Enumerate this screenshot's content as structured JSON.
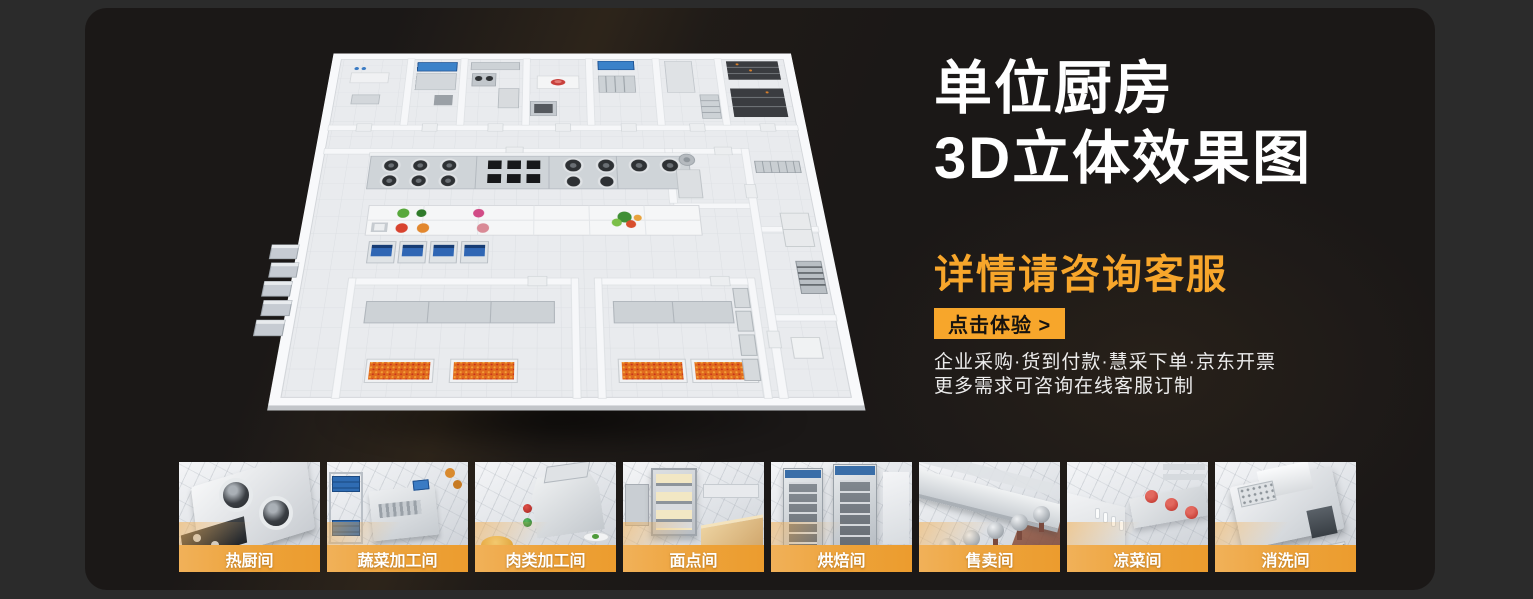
{
  "colors": {
    "page_background": "#2B2B2B",
    "card_background": "#1B1817",
    "accent_orange": "#F7A62B"
  },
  "hero": {
    "title_line1": "单位厨房",
    "title_line2": "3D立体效果图",
    "subtitle": "详情请咨询客服",
    "cta_label": "点击体验 >",
    "note_line1": "企业采购·货到付款·慧采下单·京东开票",
    "note_line2": "更多需求可咨询在线客服订制"
  },
  "gallery": {
    "items": [
      {
        "label": "热厨间"
      },
      {
        "label": "蔬菜加工间"
      },
      {
        "label": "肉类加工间"
      },
      {
        "label": "面点间"
      },
      {
        "label": "烘焙间"
      },
      {
        "label": "售卖间"
      },
      {
        "label": "凉菜间"
      },
      {
        "label": "消洗间"
      }
    ]
  }
}
